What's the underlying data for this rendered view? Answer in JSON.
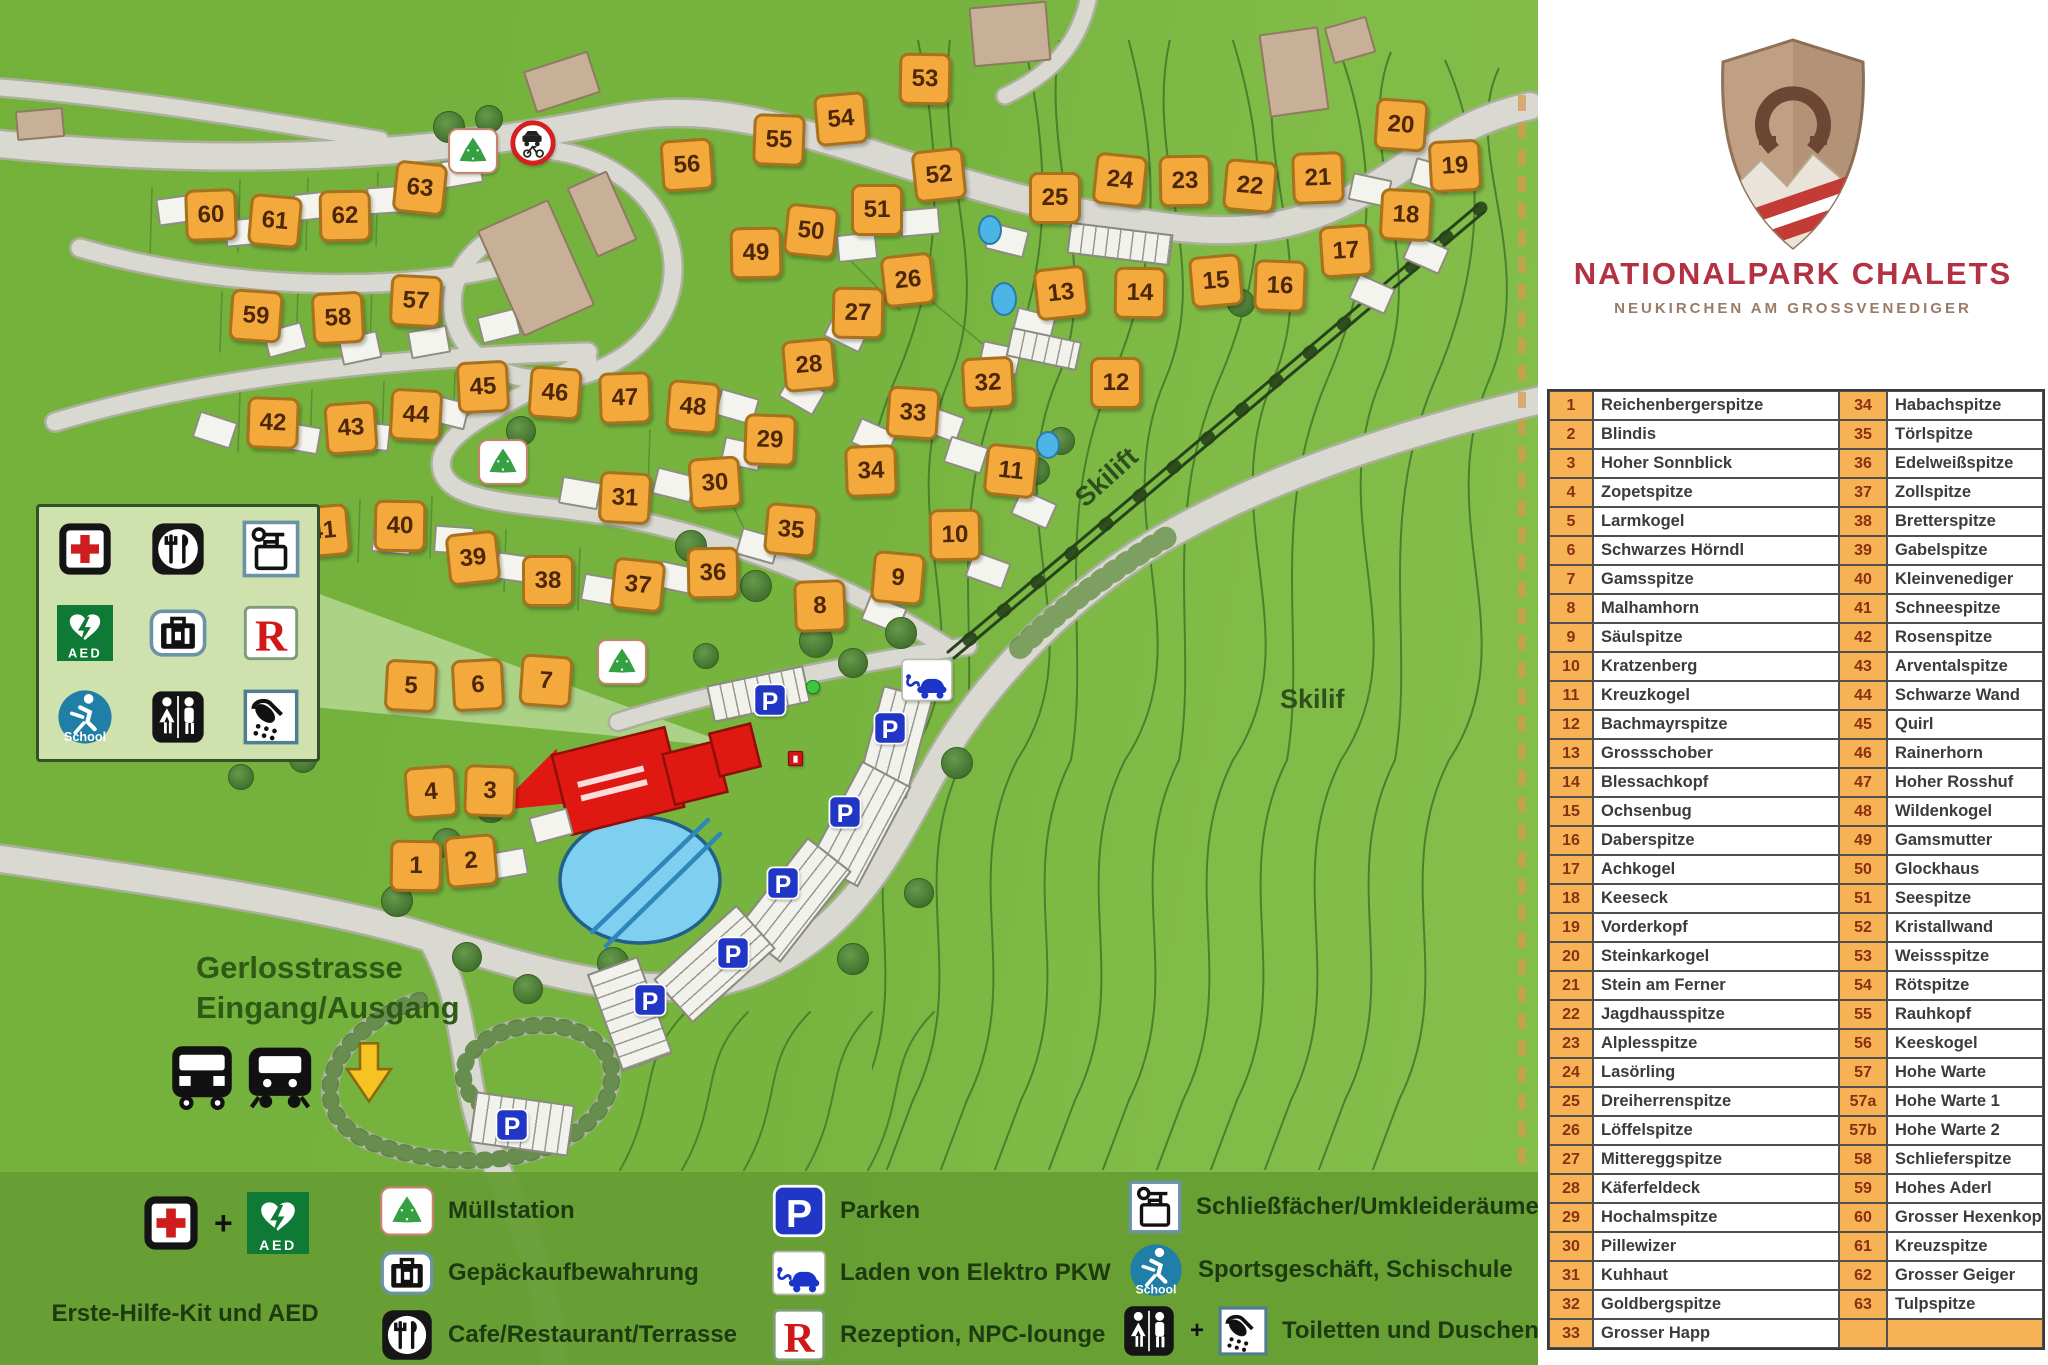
{
  "brand": {
    "title": "NATIONALPARK CHALETS",
    "subtitle": "NEUKIRCHEN AM GROSSVENEDIGER"
  },
  "map_labels": {
    "skilift_rotated": "Skilift",
    "skilift_right": "Skilif",
    "street": "Gerlosstrasse",
    "entrance": "Eingang/Ausgang"
  },
  "legend_bottom": {
    "first_aid_label": "Erste-Hilfe-Kit und AED",
    "plus": "+",
    "muellstation": "Müllstation",
    "gepaeck": "Gepäckaufbewahrung",
    "cafe": "Cafe/Restaurant/Terrasse",
    "parken": "Parken",
    "ev": "Laden von Elektro PKW",
    "rezeption": "Rezeption, NPC-lounge",
    "schliessfaecher": "Schließfächer/Umkleideräume",
    "sport": "Sportsgeschäft, Schischule",
    "toiletten": "Toiletten und Duschen"
  },
  "chalet_table": {
    "rows": [
      {
        "n1": "1",
        "name1": "Reichenbergerspitze",
        "n2": "34",
        "name2": "Habachspitze"
      },
      {
        "n1": "2",
        "name1": "Blindis",
        "n2": "35",
        "name2": "Törlspitze"
      },
      {
        "n1": "3",
        "name1": "Hoher Sonnblick",
        "n2": "36",
        "name2": "Edelweißspitze"
      },
      {
        "n1": "4",
        "name1": "Zopetspitze",
        "n2": "37",
        "name2": "Zollspitze"
      },
      {
        "n1": "5",
        "name1": "Larmkogel",
        "n2": "38",
        "name2": "Bretterspitze"
      },
      {
        "n1": "6",
        "name1": "Schwarzes Hörndl",
        "n2": "39",
        "name2": "Gabelspitze"
      },
      {
        "n1": "7",
        "name1": "Gamsspitze",
        "n2": "40",
        "name2": "Kleinvenediger"
      },
      {
        "n1": "8",
        "name1": "Malhamhorn",
        "n2": "41",
        "name2": "Schneespitze"
      },
      {
        "n1": "9",
        "name1": "Säulspitze",
        "n2": "42",
        "name2": "Rosenspitze"
      },
      {
        "n1": "10",
        "name1": "Kratzenberg",
        "n2": "43",
        "name2": "Arventalspitze"
      },
      {
        "n1": "11",
        "name1": "Kreuzkogel",
        "n2": "44",
        "name2": "Schwarze Wand"
      },
      {
        "n1": "12",
        "name1": "Bachmayrspitze",
        "n2": "45",
        "name2": "Quirl"
      },
      {
        "n1": "13",
        "name1": "Grossschober",
        "n2": "46",
        "name2": "Rainerhorn"
      },
      {
        "n1": "14",
        "name1": "Blessachkopf",
        "n2": "47",
        "name2": "Hoher Rosshuf"
      },
      {
        "n1": "15",
        "name1": "Ochsenbug",
        "n2": "48",
        "name2": "Wildenkogel"
      },
      {
        "n1": "16",
        "name1": "Daberspitze",
        "n2": "49",
        "name2": "Gamsmutter"
      },
      {
        "n1": "17",
        "name1": "Achkogel",
        "n2": "50",
        "name2": "Glockhaus"
      },
      {
        "n1": "18",
        "name1": "Keeseck",
        "n2": "51",
        "name2": "Seespitze"
      },
      {
        "n1": "19",
        "name1": "Vorderkopf",
        "n2": "52",
        "name2": "Kristallwand"
      },
      {
        "n1": "20",
        "name1": "Steinkarkogel",
        "n2": "53",
        "name2": "Weissspitze"
      },
      {
        "n1": "21",
        "name1": "Stein am Ferner",
        "n2": "54",
        "name2": "Rötspitze"
      },
      {
        "n1": "22",
        "name1": "Jagdhausspitze",
        "n2": "55",
        "name2": "Rauhkopf"
      },
      {
        "n1": "23",
        "name1": "Alplesspitze",
        "n2": "56",
        "name2": "Keeskogel"
      },
      {
        "n1": "24",
        "name1": "Lasörling",
        "n2": "57",
        "name2": "Hohe Warte"
      },
      {
        "n1": "25",
        "name1": "Dreiherrenspitze",
        "n2": "57a",
        "name2": "Hohe Warte 1"
      },
      {
        "n1": "26",
        "name1": "Löffelspitze",
        "n2": "57b",
        "name2": "Hohe Warte 2"
      },
      {
        "n1": "27",
        "name1": "Mittereggspitze",
        "n2": "58",
        "name2": "Schlieferspitze"
      },
      {
        "n1": "28",
        "name1": "Käferfeldeck",
        "n2": "59",
        "name2": "Hohes Aderl"
      },
      {
        "n1": "29",
        "name1": "Hochalmspitze",
        "n2": "60",
        "name2": "Grosser Hexenkopf"
      },
      {
        "n1": "30",
        "name1": "Pillewizer",
        "n2": "61",
        "name2": "Kreuzspitze"
      },
      {
        "n1": "31",
        "name1": "Kuhhaut",
        "n2": "62",
        "name2": "Grosser Geiger"
      },
      {
        "n1": "32",
        "name1": "Goldbergspitze",
        "n2": "63",
        "name2": "Tulpspitze"
      },
      {
        "n1": "33",
        "name1": "Grosser Happ",
        "n2": "",
        "name2": ""
      }
    ]
  },
  "map_markers": {
    "chalets": [
      {
        "n": "1",
        "x": 413,
        "y": 863
      },
      {
        "n": "2",
        "x": 468,
        "y": 858
      },
      {
        "n": "3",
        "x": 487,
        "y": 788
      },
      {
        "n": "4",
        "x": 428,
        "y": 789
      },
      {
        "n": "5",
        "x": 408,
        "y": 683
      },
      {
        "n": "6",
        "x": 475,
        "y": 682
      },
      {
        "n": "7",
        "x": 543,
        "y": 678
      },
      {
        "n": "8",
        "x": 817,
        "y": 603
      },
      {
        "n": "9",
        "x": 895,
        "y": 575
      },
      {
        "n": "10",
        "x": 952,
        "y": 532
      },
      {
        "n": "11",
        "x": 1008,
        "y": 468
      },
      {
        "n": "12",
        "x": 1113,
        "y": 380
      },
      {
        "n": "13",
        "x": 1058,
        "y": 290
      },
      {
        "n": "14",
        "x": 1137,
        "y": 290
      },
      {
        "n": "15",
        "x": 1213,
        "y": 278
      },
      {
        "n": "16",
        "x": 1277,
        "y": 283
      },
      {
        "n": "17",
        "x": 1343,
        "y": 248
      },
      {
        "n": "18",
        "x": 1403,
        "y": 212
      },
      {
        "n": "19",
        "x": 1452,
        "y": 163
      },
      {
        "n": "20",
        "x": 1398,
        "y": 122
      },
      {
        "n": "21",
        "x": 1315,
        "y": 175
      },
      {
        "n": "22",
        "x": 1247,
        "y": 183
      },
      {
        "n": "23",
        "x": 1182,
        "y": 178
      },
      {
        "n": "24",
        "x": 1117,
        "y": 177
      },
      {
        "n": "25",
        "x": 1052,
        "y": 195
      },
      {
        "n": "26",
        "x": 905,
        "y": 277
      },
      {
        "n": "27",
        "x": 855,
        "y": 310
      },
      {
        "n": "28",
        "x": 806,
        "y": 362
      },
      {
        "n": "29",
        "x": 767,
        "y": 437
      },
      {
        "n": "30",
        "x": 712,
        "y": 480
      },
      {
        "n": "31",
        "x": 622,
        "y": 495
      },
      {
        "n": "32",
        "x": 985,
        "y": 380
      },
      {
        "n": "33",
        "x": 910,
        "y": 410
      },
      {
        "n": "34",
        "x": 868,
        "y": 468
      },
      {
        "n": "35",
        "x": 788,
        "y": 527
      },
      {
        "n": "36",
        "x": 710,
        "y": 570
      },
      {
        "n": "37",
        "x": 635,
        "y": 582
      },
      {
        "n": "38",
        "x": 545,
        "y": 578
      },
      {
        "n": "39",
        "x": 470,
        "y": 555
      },
      {
        "n": "40",
        "x": 397,
        "y": 523
      },
      {
        "n": "41",
        "x": 320,
        "y": 528
      },
      {
        "n": "42",
        "x": 270,
        "y": 420
      },
      {
        "n": "43",
        "x": 348,
        "y": 425
      },
      {
        "n": "44",
        "x": 413,
        "y": 412
      },
      {
        "n": "45",
        "x": 480,
        "y": 384
      },
      {
        "n": "46",
        "x": 552,
        "y": 390
      },
      {
        "n": "47",
        "x": 622,
        "y": 395
      },
      {
        "n": "48",
        "x": 690,
        "y": 404
      },
      {
        "n": "49",
        "x": 753,
        "y": 250
      },
      {
        "n": "50",
        "x": 808,
        "y": 228
      },
      {
        "n": "51",
        "x": 874,
        "y": 207
      },
      {
        "n": "52",
        "x": 936,
        "y": 172
      },
      {
        "n": "53",
        "x": 922,
        "y": 76
      },
      {
        "n": "54",
        "x": 838,
        "y": 116
      },
      {
        "n": "55",
        "x": 776,
        "y": 137
      },
      {
        "n": "56",
        "x": 684,
        "y": 162
      },
      {
        "n": "57",
        "x": 413,
        "y": 298
      },
      {
        "n": "58",
        "x": 335,
        "y": 315
      },
      {
        "n": "59",
        "x": 253,
        "y": 313
      },
      {
        "n": "60",
        "x": 208,
        "y": 212
      },
      {
        "n": "61",
        "x": 272,
        "y": 218
      },
      {
        "n": "62",
        "x": 342,
        "y": 213
      },
      {
        "n": "63",
        "x": 417,
        "y": 185
      }
    ]
  }
}
